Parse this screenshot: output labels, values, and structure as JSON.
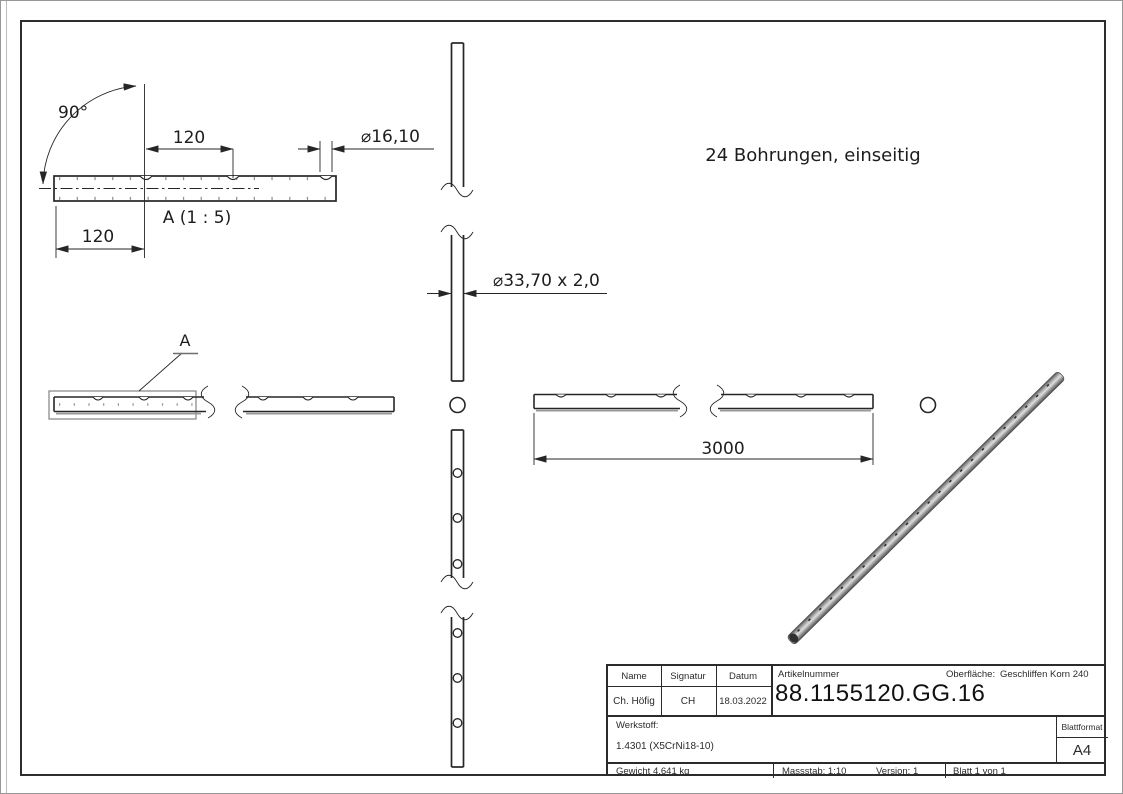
{
  "drawing": {
    "note": "24 Bohrungen, einseitig",
    "detail_view_label": "A (1 : 5)",
    "detail_marker": "A",
    "dim_angle": "90°",
    "dim_hole_spacing": "120",
    "dim_end_offset": "120",
    "dim_hole_diameter": "⌀16,10",
    "dim_tube_section": "⌀33,70 x 2,0",
    "dim_total_length": "3000"
  },
  "title_block": {
    "labels": {
      "name": "Name",
      "signature": "Signatur",
      "date": "Datum",
      "article": "Artikelnummer",
      "surface": "Oberfläche:",
      "material": "Werkstoff:",
      "sheet_format": "Blattformat"
    },
    "values": {
      "name": "Ch. Höfig",
      "signature": "CH",
      "date": "18.03.2022",
      "article": "88.1155120.GG.16",
      "surface": "Geschliffen Korn 240",
      "material": "1.4301 (X5CrNi18-10)",
      "sheet_format": "A4",
      "weight": "Gewicht 4.641 kg",
      "scale": "Massstab: 1:10",
      "version": "Version: 1",
      "sheet": "Blatt 1 von 1"
    }
  },
  "colors": {
    "line": "#262626",
    "detail_boundary": "#8c8c8c",
    "shade_gray": "#9a9a9a"
  }
}
